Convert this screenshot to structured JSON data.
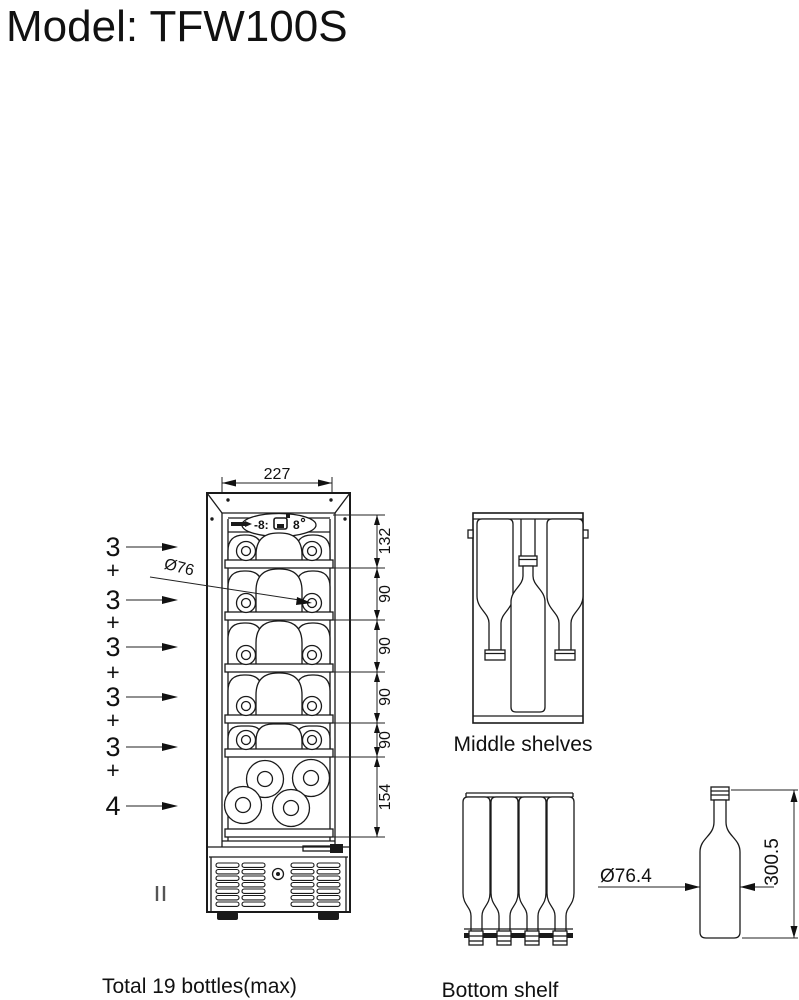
{
  "title": "Model: TFW100S",
  "front_view": {
    "top_width_dim": "227",
    "bottle_diameter_dim": "Ø76",
    "right_dims": [
      "132",
      "90",
      "90",
      "90",
      "90",
      "154"
    ],
    "shelf_counts": [
      "3",
      "3",
      "3",
      "3",
      "3",
      "4"
    ],
    "plus_signs": [
      "+",
      "+",
      "+",
      "+",
      "+"
    ],
    "panel": {
      "display_left": "-8:",
      "display_right": "8"
    }
  },
  "middle_shelves": {
    "caption": "Middle shelves"
  },
  "bottom_shelf": {
    "caption": "Bottom shelf"
  },
  "bottle_figure": {
    "diameter_dim": "Ø76.4",
    "height_dim": "300.5"
  },
  "notes": {
    "total": "Total 19 bottles(max)"
  }
}
